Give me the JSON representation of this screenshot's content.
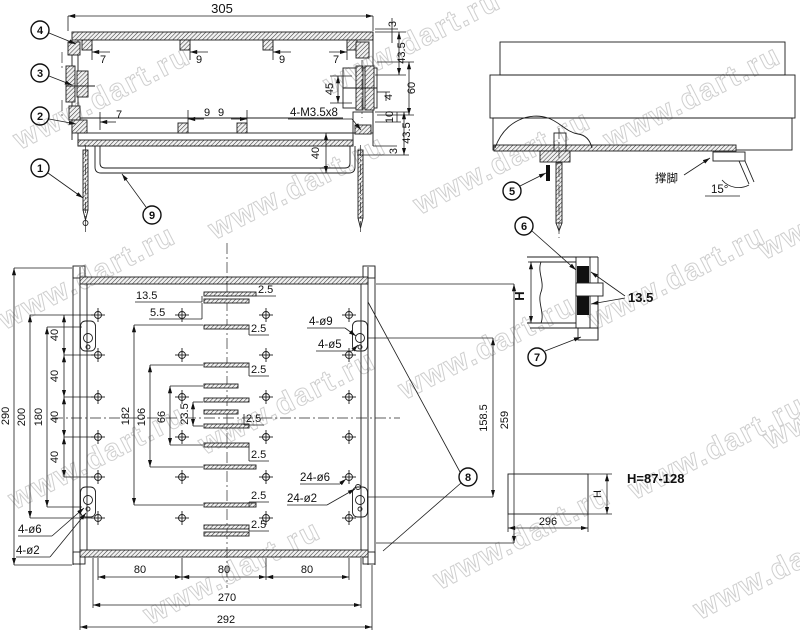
{
  "watermark": {
    "text": "www.dart.ru"
  },
  "balloons": [
    "1",
    "2",
    "3",
    "4",
    "5",
    "6",
    "7",
    "8",
    "9"
  ],
  "front_view": {
    "overall_width": "305",
    "top_dims": [
      "7",
      "9",
      "9",
      "7"
    ],
    "bottom_dims": [
      "7",
      "9",
      "9"
    ],
    "right": {
      "top_lip": "3",
      "upper_h": "43.5",
      "clamp_h": "45",
      "step": "4",
      "mid_h": "60",
      "step2": "10",
      "lower_h": "43.5",
      "bottom_lip": "3"
    },
    "bail_depth": "40",
    "thread_label": "4-M3.5x8"
  },
  "side_view": {
    "foot_label": "撑脚",
    "foot_angle": "15°"
  },
  "clamp_detail": {
    "height_label": "H",
    "gap": "13.5"
  },
  "height_detail": {
    "width": "296",
    "height_label": "H",
    "range": "H=87-128"
  },
  "plan_view": {
    "outer_h": "290",
    "h200": "200",
    "h180": "180",
    "pitch": [
      "40",
      "40",
      "40",
      "40"
    ],
    "w182": "182",
    "w106": "106",
    "w66": "66",
    "w23_5": "23.5",
    "d13_5": "13.5",
    "d5_5": "5.5",
    "offsets": [
      "2.5",
      "2.5",
      "2.5",
      "2.5",
      "2.5",
      "2.5",
      "2.5"
    ],
    "r158_5": "158.5",
    "r259": "259",
    "labels": {
      "tr_big": "4-ø9",
      "tr_small": "4-ø5",
      "mid_big": "24-ø6",
      "mid_small": "24-ø2",
      "bl_big": "4-ø6",
      "bl_small": "4-ø2"
    },
    "bottom_80": [
      "80",
      "80",
      "80"
    ],
    "b270": "270",
    "b292": "292"
  }
}
